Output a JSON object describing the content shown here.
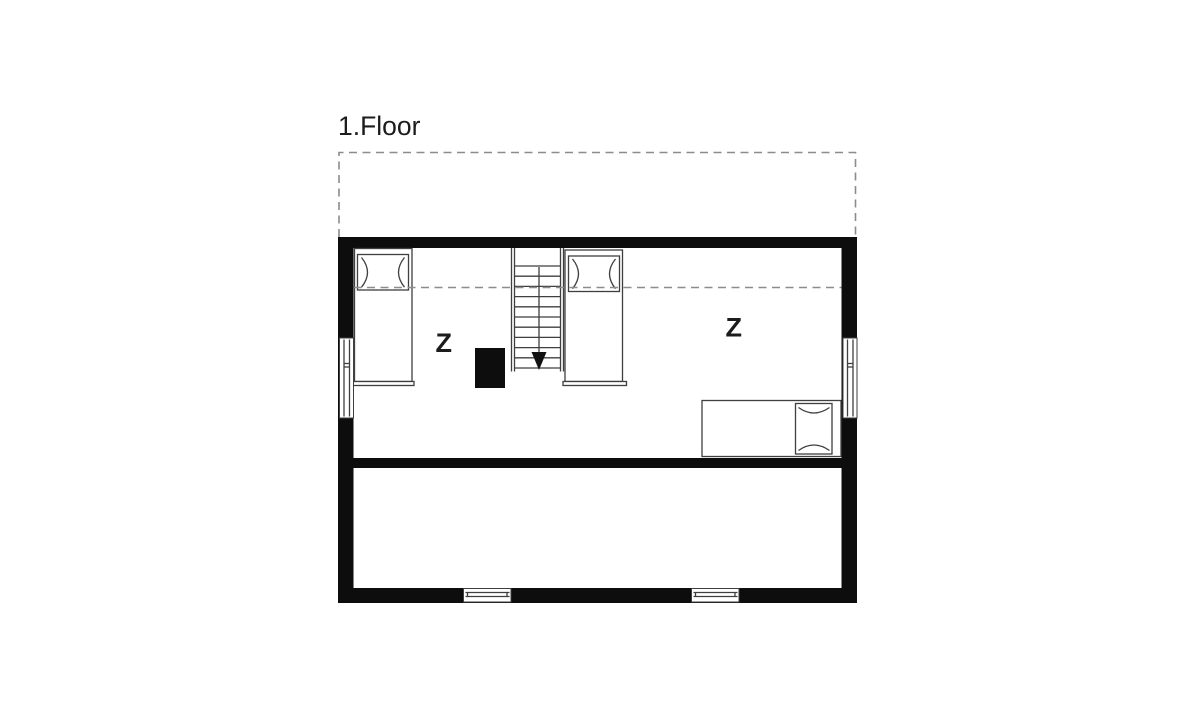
{
  "title": "1.Floor",
  "rooms": [
    {
      "name": "sleeping-area-left",
      "label": "Z"
    },
    {
      "name": "sleeping-area-right",
      "label": "Z"
    }
  ],
  "elements": [
    "roof-overhang-dashed-outline",
    "knee-wall-dashed-line",
    "single-bed-with-pillow-top-left",
    "single-bed-with-pillow-center",
    "single-bed-with-pillow-bottom-right",
    "staircase-going-down-with-arrow",
    "chimney-block",
    "window-left-wall",
    "window-right-wall",
    "window-bottom-wall-left",
    "window-bottom-wall-right",
    "lower-empty-room"
  ],
  "colors": {
    "background": "#ffffff",
    "walls": "#0d0d0d",
    "furniture_lines": "#3f3f3f",
    "dashed_lines": "#8c8c8c",
    "text": "#1c1c1c"
  }
}
